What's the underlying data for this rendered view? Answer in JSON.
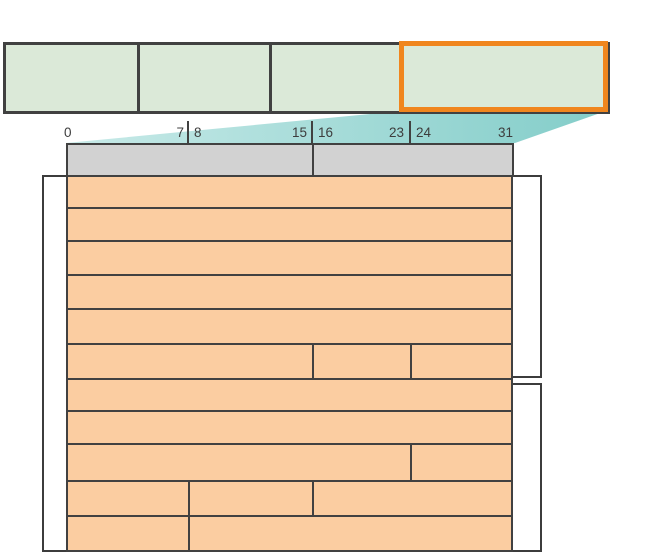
{
  "diagram": {
    "kind": "packet-structure-bit-field-diagram",
    "colors": {
      "background": "#ffffff",
      "outline": "#414141",
      "frame_fill": "#dbe9d8",
      "highlight_border": "#f0861e",
      "callout_fill_left": "#c8eae8",
      "callout_fill_right": "#83cdc9",
      "word_header_fill": "#d2d2d2",
      "field_fill": "#fbcda1",
      "bracket_outline": "#3c3c3c",
      "label_color": "#3d3d3d"
    },
    "frame": {
      "segment_count": 4,
      "highlighted_segment_index": 3,
      "segment_bounds_x": [
        3,
        137,
        269,
        399,
        607
      ],
      "y": 42,
      "height": 69,
      "highlight_box": {
        "left": 399,
        "top": 41,
        "width": 209,
        "height": 71
      }
    },
    "callout": {
      "polygon_points": [
        [
          401,
          111
        ],
        [
          606,
          111
        ],
        [
          515,
          143
        ],
        [
          66,
          143
        ]
      ]
    },
    "bit_scale": {
      "labels": [
        {
          "text": "0",
          "x": 64,
          "align": "left"
        },
        {
          "text": "7",
          "x": 184,
          "align": "right"
        },
        {
          "text": "8",
          "x": 194,
          "align": "left"
        },
        {
          "text": "15",
          "x": 307,
          "align": "right"
        },
        {
          "text": "16",
          "x": 318,
          "align": "left"
        },
        {
          "text": "23",
          "x": 404,
          "align": "right"
        },
        {
          "text": "24",
          "x": 416,
          "align": "left"
        },
        {
          "text": "31",
          "x": 513,
          "align": "right"
        }
      ],
      "label_top": 126,
      "ticks_x": [
        187,
        311,
        409
      ],
      "tick_top": 121,
      "tick_height": 22
    },
    "word_header": {
      "y": 143,
      "height": 32,
      "cells_x": [
        [
          66,
          312
        ],
        [
          312,
          512
        ]
      ]
    },
    "field_table": {
      "bit_boundary_x": {
        "0": 66,
        "8": 188,
        "16": 312,
        "24": 410,
        "32": 511
      },
      "row_boundaries_y": [
        175,
        207,
        240,
        274,
        308,
        343,
        378,
        410,
        443,
        480,
        515,
        550
      ],
      "rows": [
        {
          "cells": [
            [
              0,
              31
            ]
          ]
        },
        {
          "cells": [
            [
              0,
              31
            ]
          ]
        },
        {
          "cells": [
            [
              0,
              31
            ]
          ]
        },
        {
          "cells": [
            [
              0,
              31
            ]
          ]
        },
        {
          "cells": [
            [
              0,
              31
            ]
          ]
        },
        {
          "cells": [
            [
              0,
              15
            ],
            [
              16,
              23
            ],
            [
              24,
              31
            ]
          ]
        },
        {
          "cells": [
            [
              0,
              31
            ]
          ]
        },
        {
          "cells": [
            [
              0,
              31
            ]
          ]
        },
        {
          "cells": [
            [
              0,
              23
            ],
            [
              24,
              31
            ]
          ]
        },
        {
          "cells": [
            [
              0,
              7
            ],
            [
              8,
              15
            ],
            [
              16,
              31
            ]
          ]
        },
        {
          "cells": [
            [
              0,
              7
            ],
            [
              8,
              31
            ]
          ]
        }
      ]
    },
    "brackets": [
      {
        "id": "left-span-bracket",
        "x": 42,
        "y": 175,
        "width": 26,
        "height": 377
      },
      {
        "id": "right-span-bracket-top",
        "x": 511,
        "y": 175,
        "width": 31,
        "height": 203
      },
      {
        "id": "right-span-bracket-bottom",
        "x": 511,
        "y": 383,
        "width": 31,
        "height": 169
      }
    ]
  }
}
